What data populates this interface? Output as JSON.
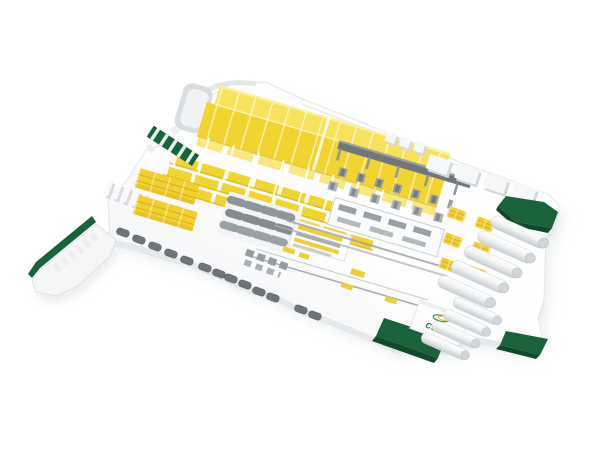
{
  "logo": {
    "text": "CSRP"
  },
  "colors": {
    "background": "#ffffff",
    "floor_light": "#ffffff",
    "floor_shade": "#edf0f1",
    "floor_edge": "#e6e9eb",
    "ground_shadow": "#dfe3e5",
    "roof_yellow": "#f6e35b",
    "side_yellow": "#f1d42f",
    "trim_yellow": "#f8e87d",
    "stack_yellow": "#f2cf2e",
    "stripe_yellow": "#d8b822",
    "dark_green": "#1a6239",
    "darker_green": "#114a2b",
    "logo_green": "#1b6e3e",
    "swoosh_green": "#3a9a4a",
    "machine_dark": "#70767b",
    "machine_gray": "#8f969b",
    "machine_light": "#b0b5b9",
    "vehicle_gray": "#6e7478",
    "tank_shade": "#c7ccd0"
  }
}
